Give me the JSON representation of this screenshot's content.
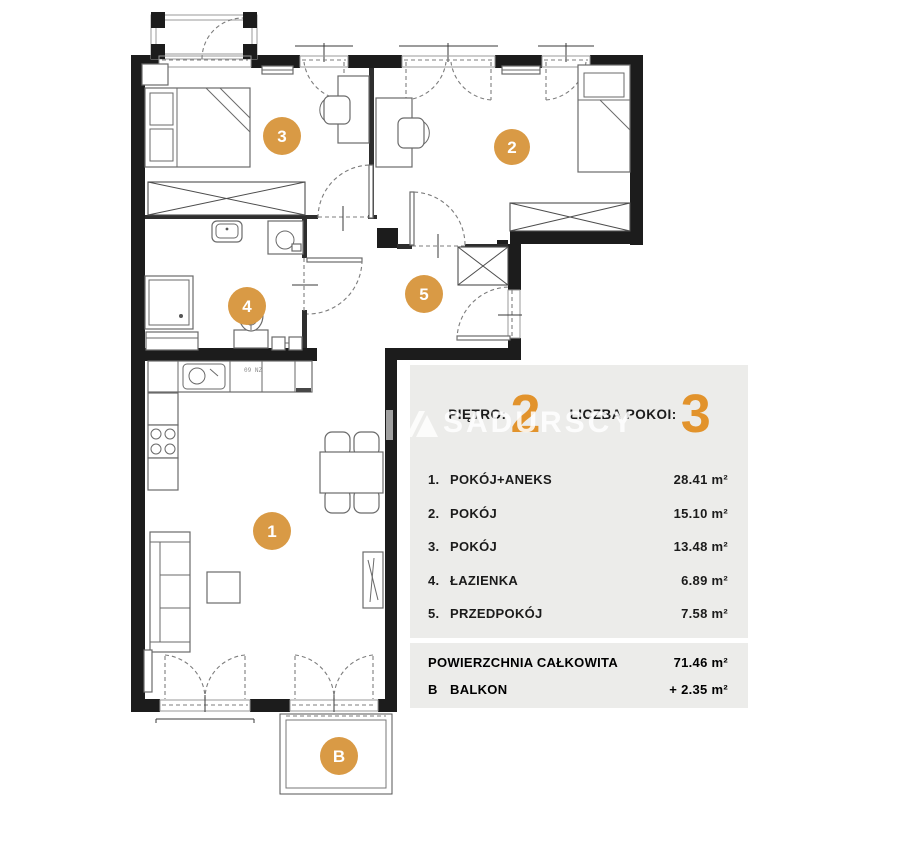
{
  "panel": {
    "header": [
      {
        "label": "PIĘTRO:",
        "value": "2"
      },
      {
        "label": "LICZBA POKOI:",
        "value": "3"
      }
    ],
    "rooms": [
      {
        "no": "1.",
        "name": "POKÓJ+ANEKS",
        "area": "28.41 m²"
      },
      {
        "no": "2.",
        "name": "POKÓJ",
        "area": "15.10 m²"
      },
      {
        "no": "3.",
        "name": "POKÓJ",
        "area": "13.48 m²"
      },
      {
        "no": "4.",
        "name": "ŁAZIENKA",
        "area": "6.89 m²"
      },
      {
        "no": "5.",
        "name": "PRZEDPOKÓJ",
        "area": "7.58 m²"
      }
    ],
    "summary": [
      {
        "no": "",
        "name": "POWIERZCHNIA CAŁKOWITA",
        "area": "71.46 m²"
      },
      {
        "no": "B",
        "name": "BALKON",
        "area": "+  2.35 m²"
      }
    ]
  },
  "watermark": {
    "text": "SADURSCY"
  },
  "plan": {
    "markers": [
      "1",
      "2",
      "3",
      "4",
      "5",
      "B"
    ],
    "kitchen_label": "09 NZ"
  },
  "colors": {
    "marker_orange": "#D99A45",
    "numeral_orange": "#E2932C",
    "panel_gray": "#ECECEA",
    "wall_black": "#1c1c1c"
  }
}
